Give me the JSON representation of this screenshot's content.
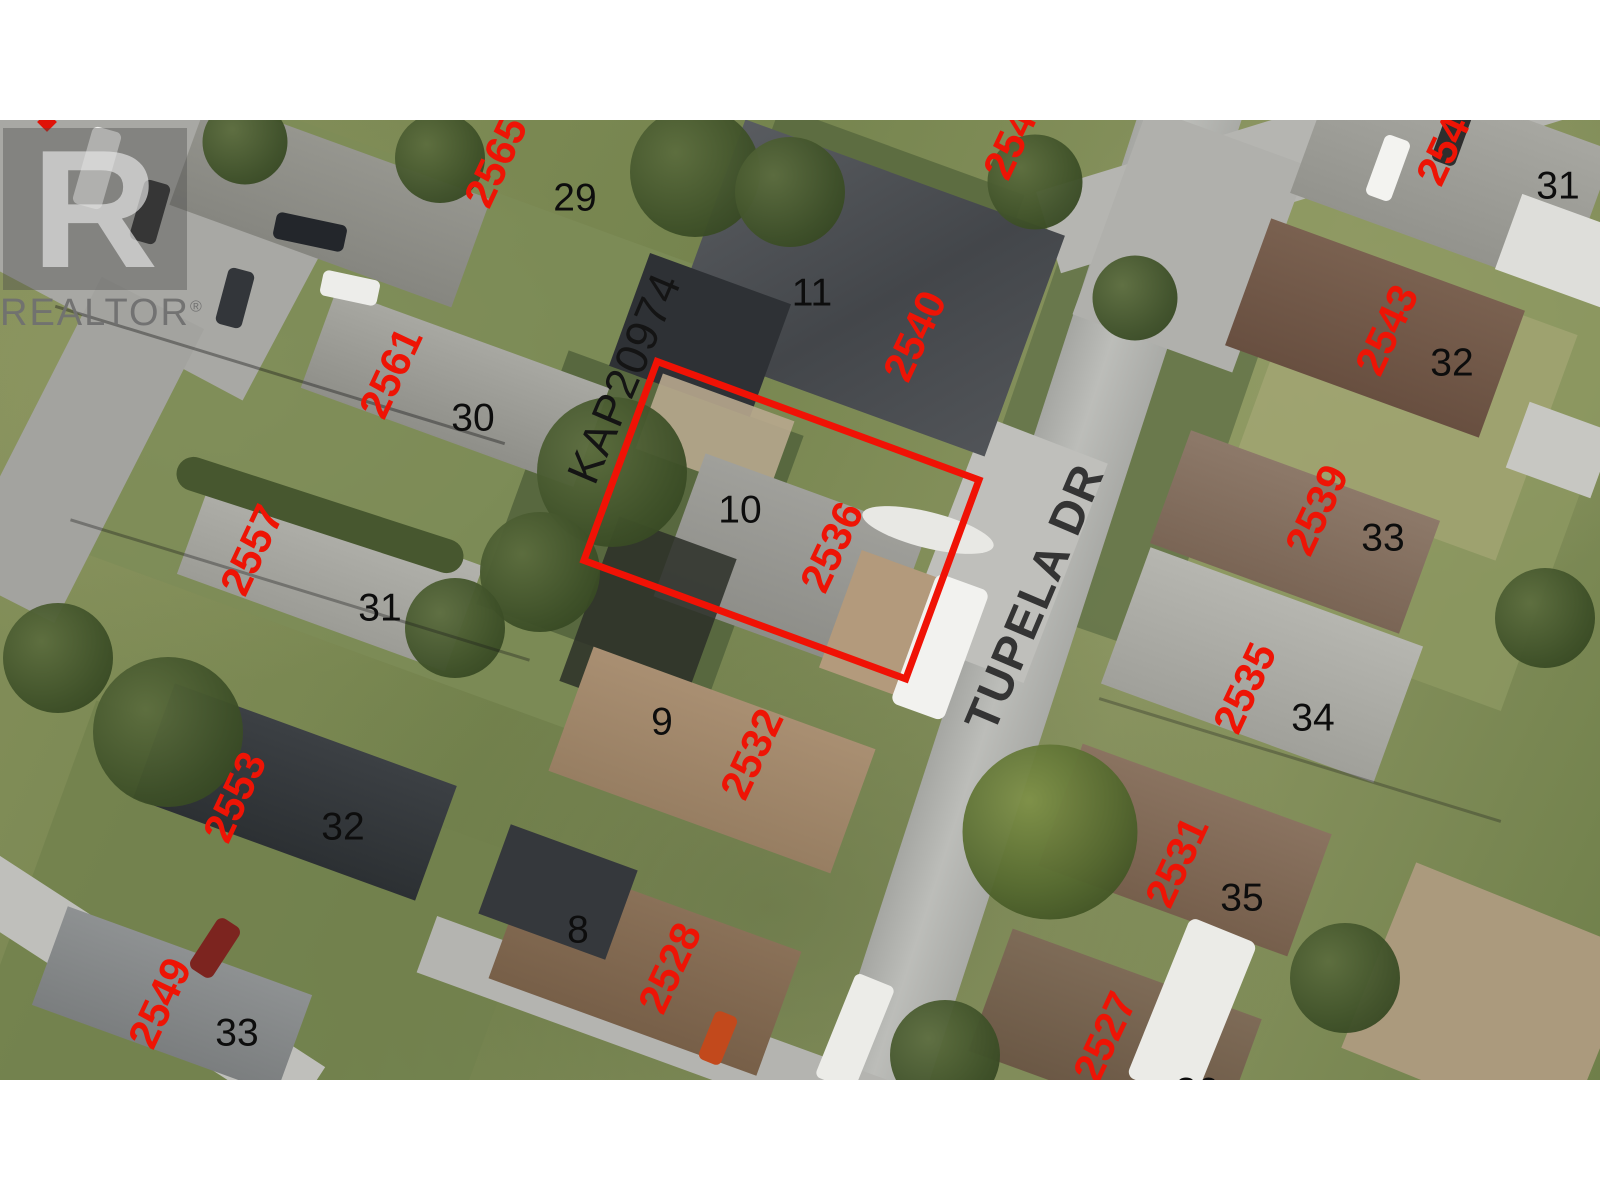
{
  "watermark": {
    "logo_letter": "R",
    "wordmark": "REALTOR",
    "registered_mark": "®"
  },
  "map": {
    "street_name": "TUPELA DR",
    "plan_number": "KAP20974",
    "highlighted_parcel": "2536",
    "colors": {
      "parcel_outline_red": "#f01205",
      "house_number_red": "#ee1405",
      "lot_number_black": "#0d0d0d",
      "street_name_gray": "#343434"
    },
    "labels": [
      {
        "name": "house-number-2565",
        "kind": "house-number",
        "text": "2565",
        "x": 496,
        "y": 42,
        "rot": -65
      },
      {
        "name": "house-number-2561",
        "kind": "house-number",
        "text": "2561",
        "x": 391,
        "y": 253,
        "rot": -65
      },
      {
        "name": "house-number-2557",
        "kind": "house-number",
        "text": "2557",
        "x": 252,
        "y": 430,
        "rot": -65
      },
      {
        "name": "house-number-2553",
        "kind": "house-number",
        "text": "2553",
        "x": 235,
        "y": 677,
        "rot": -65
      },
      {
        "name": "house-number-2549",
        "kind": "house-number",
        "text": "2549",
        "x": 160,
        "y": 883,
        "rot": -65
      },
      {
        "name": "house-number-2544-clipped",
        "kind": "house-number",
        "text": "2544",
        "x": 1015,
        "y": 14,
        "rot": -65
      },
      {
        "name": "house-number-2540",
        "kind": "house-number",
        "text": "2540",
        "x": 915,
        "y": 216,
        "rot": -65
      },
      {
        "name": "house-number-2536-highlighted-parcel",
        "kind": "house-number",
        "text": "2536",
        "x": 832,
        "y": 427,
        "rot": -65
      },
      {
        "name": "house-number-2532",
        "kind": "house-number",
        "text": "2532",
        "x": 752,
        "y": 634,
        "rot": -65
      },
      {
        "name": "house-number-2528",
        "kind": "house-number",
        "text": "2528",
        "x": 670,
        "y": 848,
        "rot": -65
      },
      {
        "name": "house-number-2547-clipped",
        "kind": "house-number",
        "text": "2547",
        "x": 1448,
        "y": 20,
        "rot": -65
      },
      {
        "name": "house-number-2543",
        "kind": "house-number",
        "text": "2543",
        "x": 1387,
        "y": 210,
        "rot": -65
      },
      {
        "name": "house-number-2539",
        "kind": "house-number",
        "text": "2539",
        "x": 1317,
        "y": 390,
        "rot": -65
      },
      {
        "name": "house-number-2535",
        "kind": "house-number",
        "text": "2535",
        "x": 1245,
        "y": 568,
        "rot": -65
      },
      {
        "name": "house-number-2531",
        "kind": "house-number",
        "text": "2531",
        "x": 1177,
        "y": 742,
        "rot": -65
      },
      {
        "name": "house-number-2527",
        "kind": "house-number",
        "text": "2527",
        "x": 1105,
        "y": 917,
        "rot": -65
      },
      {
        "name": "lot-number-29",
        "kind": "lot-number",
        "text": "29",
        "x": 575,
        "y": 78,
        "rot": 0
      },
      {
        "name": "lot-number-30",
        "kind": "lot-number",
        "text": "30",
        "x": 473,
        "y": 298,
        "rot": 0
      },
      {
        "name": "lot-number-31-left",
        "kind": "lot-number",
        "text": "31",
        "x": 380,
        "y": 488,
        "rot": 0
      },
      {
        "name": "lot-number-32-left",
        "kind": "lot-number",
        "text": "32",
        "x": 343,
        "y": 707,
        "rot": 0
      },
      {
        "name": "lot-number-33-left",
        "kind": "lot-number",
        "text": "33",
        "x": 237,
        "y": 913,
        "rot": 0
      },
      {
        "name": "lot-number-11",
        "kind": "lot-number",
        "text": "11",
        "x": 812,
        "y": 173,
        "rot": 0
      },
      {
        "name": "lot-number-10",
        "kind": "lot-number",
        "text": "10",
        "x": 740,
        "y": 390,
        "rot": 0
      },
      {
        "name": "lot-number-9",
        "kind": "lot-number",
        "text": "9",
        "x": 662,
        "y": 602,
        "rot": 0
      },
      {
        "name": "lot-number-8",
        "kind": "lot-number",
        "text": "8",
        "x": 578,
        "y": 810,
        "rot": 0
      },
      {
        "name": "lot-number-31-right",
        "kind": "lot-number",
        "text": "31",
        "x": 1558,
        "y": 66,
        "rot": 0
      },
      {
        "name": "lot-number-32-right",
        "kind": "lot-number",
        "text": "32",
        "x": 1452,
        "y": 243,
        "rot": 0
      },
      {
        "name": "lot-number-33-right",
        "kind": "lot-number",
        "text": "33",
        "x": 1383,
        "y": 418,
        "rot": 0
      },
      {
        "name": "lot-number-34",
        "kind": "lot-number",
        "text": "34",
        "x": 1313,
        "y": 598,
        "rot": 0
      },
      {
        "name": "lot-number-35",
        "kind": "lot-number",
        "text": "35",
        "x": 1242,
        "y": 778,
        "rot": 0
      },
      {
        "name": "lot-number-36-clipped",
        "kind": "lot-number",
        "text": "36",
        "x": 1197,
        "y": 972,
        "rot": 0
      },
      {
        "name": "plan-number-kap20974",
        "kind": "plan-number",
        "text": "KAP20974",
        "x": 624,
        "y": 258,
        "rot": -67
      },
      {
        "name": "street-name-tupela-dr",
        "kind": "street-name",
        "text": "TUPELA DR",
        "x": 1034,
        "y": 477,
        "rot": -67
      }
    ]
  }
}
